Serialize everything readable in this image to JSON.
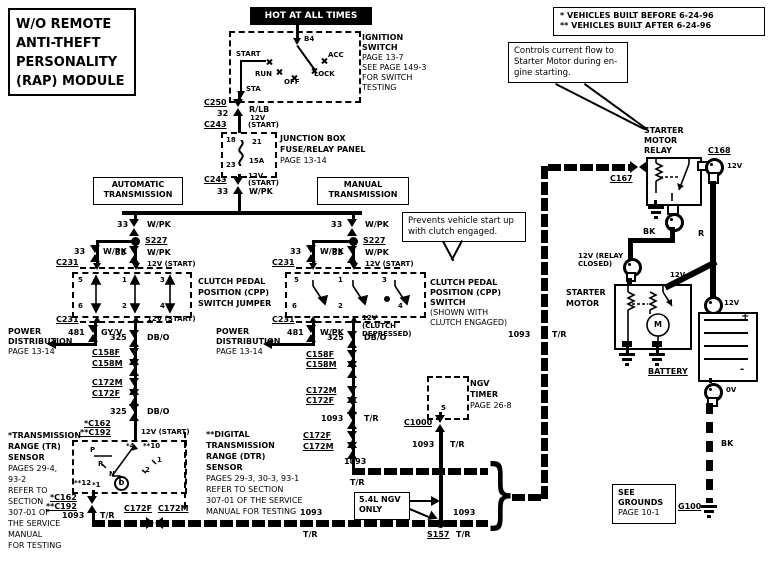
{
  "title": {
    "lines": [
      "W/O  REMOTE",
      "ANTI-THEFT",
      "PERSONALITY",
      "(RAP)  MODULE"
    ]
  },
  "power_banner": "HOT AT ALL TIMES",
  "build_note": {
    "line1": "* VEHICLES BUILT BEFORE 6-24-96",
    "line2": "** VEHICLES BUILT AFTER 6-24-96"
  },
  "ignition_switch": {
    "label_lines": [
      "IGNITION",
      "SWITCH",
      "PAGE 13-7",
      "SEE PAGE 149-3",
      "FOR SWITCH",
      "TESTING"
    ],
    "terminal": "B4",
    "positions": {
      "start": "START",
      "run": "RUN",
      "off": "OFF",
      "lock": "LOCK",
      "acc": "ACC",
      "sta": "STA"
    }
  },
  "relay_callout_lines": [
    "Controls current flow to",
    "Starter Motor during en-",
    "gine starting."
  ],
  "clutch_callout_lines": [
    "Prevents vehicle start up",
    "with clutch engaged."
  ],
  "supply": {
    "c250": "C250",
    "ckt32": "32",
    "clr32": "R/LB",
    "v32a": "12V",
    "v32b": "(START)",
    "c243_in": "C243",
    "jb_pin_in": "18",
    "jb_fuse": "21",
    "jb_amp": "15A",
    "jb_pin_out": "23",
    "jb_lines": [
      "JUNCTION BOX",
      "FUSE/RELAY PANEL",
      "PAGE 13-14"
    ],
    "c243_out": "C243",
    "v33a": "12V",
    "v33b": "(START)",
    "ckt33": "33",
    "clr33": "W/PK"
  },
  "auto_header_lines": [
    "AUTOMATIC",
    "TRANSMISSION"
  ],
  "manual_header_lines": [
    "MANUAL",
    "TRANSMISSION"
  ],
  "left": {
    "ckt_a": "33",
    "clr_a": "W/PK",
    "splice": "S227",
    "ckt_b": "33",
    "clr_b": "W/PK",
    "ckt_c": "33",
    "clr_c": "W/PK",
    "v_c": "12V (START)",
    "c231_top": "C231",
    "pin5": "5",
    "pin1": "1",
    "pin3": "3",
    "pin6": "6",
    "pin2": "2",
    "pin4": "4",
    "jumper_lines": [
      "CLUTCH PEDAL",
      "POSITION (CPP)",
      "SWITCH JUMPER"
    ],
    "c231_bot": "C231",
    "v_bot": "12V (START)",
    "ckt481": "481",
    "clr481": "GY/V",
    "pd_lines": [
      "POWER",
      "DISTRIBUTION",
      "PAGE 13-14"
    ],
    "ckt325_1": "325",
    "clr325_1": "DB/O",
    "c158f": "C158F",
    "c158m": "C158M",
    "ckt325_2": "325",
    "clr325_2": "DB/O",
    "c172m": "C172M",
    "c172f": "C172F",
    "ckt325_3": "325",
    "clr325_3": "DB/O",
    "c162": "*C162",
    "c192": "**C192",
    "v_sensor": "12V (START)"
  },
  "tr": {
    "note_lines": [
      "*TRANSMISSION",
      "RANGE (TR)",
      "SENSOR",
      "PAGES 29-4,",
      "93-2",
      "REFER TO",
      "SECTION",
      "307-01 OF",
      "THE SERVICE",
      "MANUAL",
      "FOR TESTING"
    ],
    "pin_top_l": "*4",
    "pin_top_r": "**10",
    "pin_bot_l": "**12",
    "pin_bot_r": "*1",
    "p": "P",
    "r": "R",
    "n": "N",
    "d": "D",
    "g2": "2",
    "g1": "1",
    "c162": "*C162",
    "c192": "**C192",
    "ckt": "1093",
    "clr": "T/R"
  },
  "bus_low": {
    "c172f": "C172F",
    "c172m": "C172M",
    "ckt_mid": "1093",
    "clr_mid": "T/R",
    "s157": "S157",
    "ckt_r": "1093",
    "clr_r": "T/R"
  },
  "mid": {
    "ckt_a": "33",
    "clr_a": "W/PK",
    "splice": "S227",
    "ckt_b": "33",
    "clr_b": "W/PK",
    "ckt_c": "33",
    "clr_c": "W/PK",
    "v_c": "12V (START)",
    "c231_top": "C231",
    "pin5": "5",
    "pin1": "1",
    "pin3": "3",
    "pin6": "6",
    "pin2": "2",
    "pin4": "4",
    "switch_lines": [
      "CLUTCH PEDAL",
      "POSITION (CPP)",
      "SWITCH",
      "(SHOWN WITH",
      "CLUTCH ENGAGED)"
    ],
    "c231_bot": "C231",
    "v_bot_lines": [
      "12V",
      "(CLUTCH",
      "DEPRESSED)"
    ],
    "ckt481": "481",
    "clr481": "W/PK",
    "pd_lines": [
      "POWER",
      "DISTRIBUTION",
      "PAGE 13-14"
    ],
    "ckt325_1": "325",
    "clr325_1": "DB/O",
    "c158f": "C158F",
    "c158m": "C158M",
    "ckt325_2": "325",
    "clr325_2": "DB/O",
    "c172m": "C172M",
    "c172f": "C172F",
    "ckt1093": "1093",
    "clr1093": "T/R",
    "c172f2": "C172F",
    "c172m2": "C172M",
    "turn_ckt": "1093",
    "turn_clr": "T/R"
  },
  "dtr_note_lines": [
    "**DIGITAL",
    "TRANSMISSION",
    "RANGE (DTR)",
    "SENSOR",
    "PAGES 29-3, 30-3, 93-1",
    "REFER TO SECTION",
    "307-01 OF THE SERVICE",
    "MANUAL FOR TESTING"
  ],
  "ngv": {
    "box_lines": [
      "NGV",
      "TIMER",
      "PAGE 26-8"
    ],
    "pin": "5",
    "c1000": "C1000",
    "ckt": "1093",
    "clr": "T/R",
    "only_lines": [
      "5.4L NGV",
      "ONLY"
    ]
  },
  "riser": {
    "ckt": "1093",
    "clr": "T/R"
  },
  "relay": {
    "title_lines": [
      "STARTER",
      "MOTOR",
      "RELAY"
    ],
    "c167": "C167",
    "c168": "C168",
    "v168": "12V",
    "bk": "BK",
    "r": "R"
  },
  "starter": {
    "title_lines": [
      "STARTER",
      "MOTOR"
    ],
    "closed_lines": [
      "12V (RELAY",
      "CLOSED)"
    ],
    "v_top": "12V",
    "m": "M"
  },
  "battery": {
    "label": "BATTERY",
    "plus": "+",
    "minus": "-",
    "v_top": "12V",
    "v_bot": "0V",
    "bk": "BK"
  },
  "ground": {
    "box_lines": [
      "SEE",
      "GROUNDS",
      "PAGE 10-1"
    ],
    "g100": "G100"
  }
}
